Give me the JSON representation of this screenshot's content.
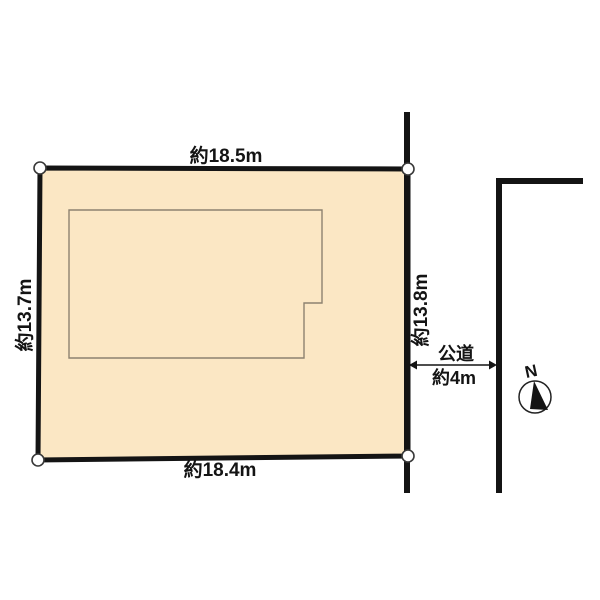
{
  "colors": {
    "background": "#FFFFFF",
    "parcel_fill": "#FBE7C4",
    "line_black": "#141414",
    "building_outline": "#8D8270"
  },
  "parcel": {
    "dim_top": "約18.5m",
    "dim_bottom": "約18.4m",
    "dim_left": "約13.7m",
    "dim_right": "約13.8m"
  },
  "road": {
    "name": "公道",
    "width": "約4m"
  },
  "compass": {
    "north": "N"
  }
}
